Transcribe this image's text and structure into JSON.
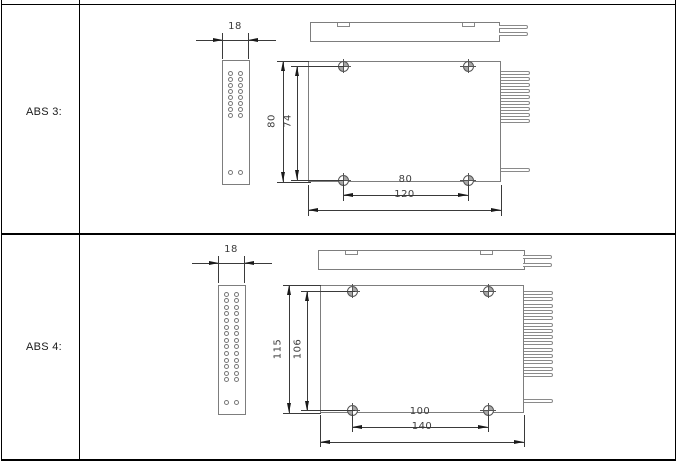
{
  "rows": [
    {
      "label": "ABS 3:",
      "dims": {
        "side_width": "18",
        "height": "80",
        "inner_height": "74",
        "screw_spacing": "80",
        "width": "120"
      },
      "features": {
        "side_hole_rows": 8,
        "side_hole_cols": 2,
        "side_bottom_holes": 2,
        "screw_count": 4,
        "comb_fiber_count": 9,
        "lower_fiber_count": 1,
        "top_lead_count": 2,
        "top_notch_count": 2
      }
    },
    {
      "label": "ABS 4:",
      "dims": {
        "side_width": "18",
        "height": "115",
        "inner_height": "106",
        "screw_spacing": "100",
        "width": "140"
      },
      "features": {
        "side_hole_rows": 14,
        "side_hole_cols": 2,
        "side_bottom_holes": 2,
        "screw_count": 4,
        "comb_fiber_count": 14,
        "lower_fiber_count": 1,
        "top_lead_count": 2,
        "top_notch_count": 2
      }
    }
  ],
  "colors": {
    "outline": "#7d7d7d",
    "dimension": "#3a3a3a",
    "table_border": "#000000",
    "background": "#ffffff"
  }
}
